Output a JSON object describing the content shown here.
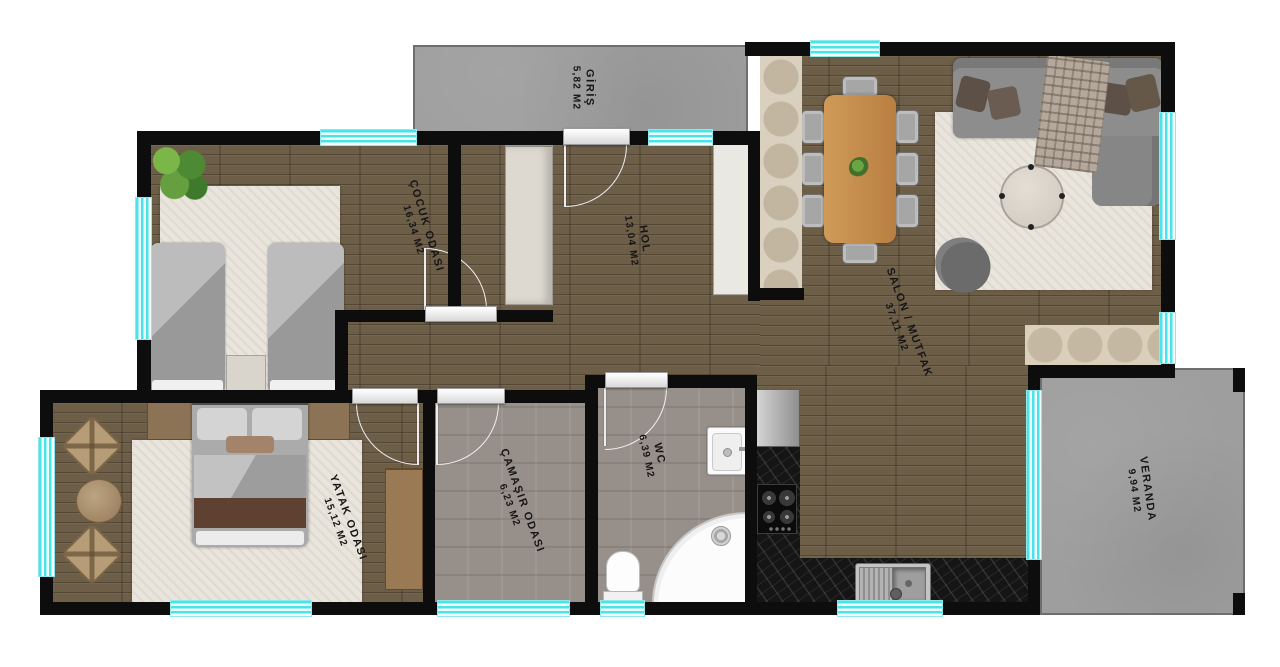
{
  "plan": {
    "type": "floor-plan",
    "language": "tr",
    "rooms": [
      {
        "name": "GİRİŞ",
        "area": "5,82 M2"
      },
      {
        "name": "ÇOCUK ODASI",
        "area": "16,34 M2"
      },
      {
        "name": "HOL",
        "area": "13,04 M2"
      },
      {
        "name": "SALON / MUTFAK",
        "area": "37,11 M2"
      },
      {
        "name": "YATAK ODASI",
        "area": "15,12 M2"
      },
      {
        "name": "ÇAMAŞIR ODASI",
        "area": "6,23 M2"
      },
      {
        "name": "WC",
        "area": "6,39 M2"
      },
      {
        "name": "VERANDA",
        "area": "9,94 M2"
      }
    ],
    "colors": {
      "wall": "#0d0d0d",
      "window": "#49e3e8",
      "wood_floor": "#6d5e48",
      "tile_floor": "#97908a",
      "concrete": "#9e9e9e",
      "counter_marble": "#151515",
      "rug": "#e9e5dd",
      "label_text": "#161616"
    }
  }
}
